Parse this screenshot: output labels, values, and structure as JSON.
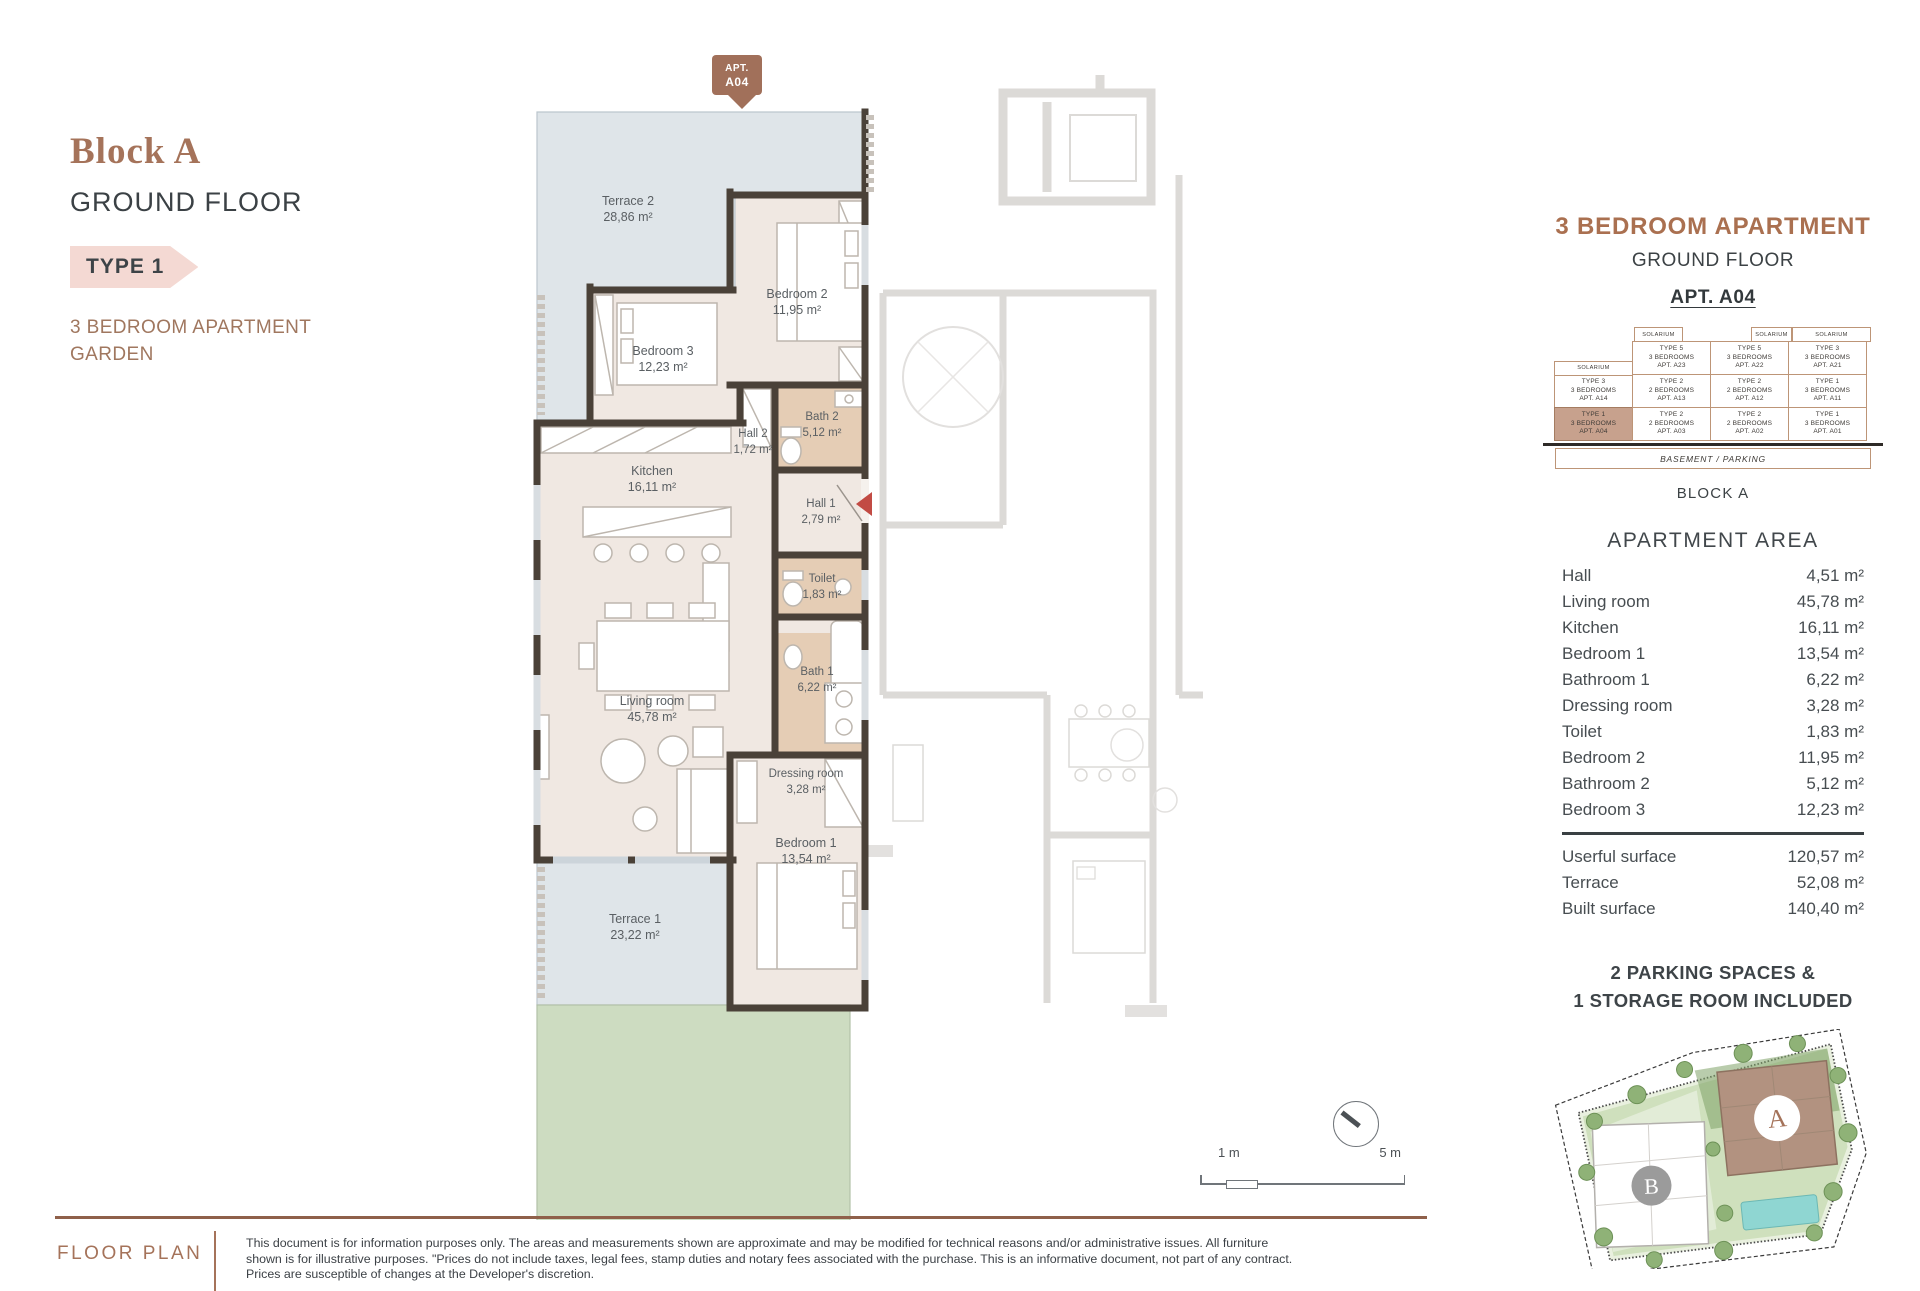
{
  "header": {
    "block_title": "Block A",
    "floor": "GROUND FLOOR",
    "type_tag": "TYPE 1",
    "subtitle_line1": "3 BEDROOM APARTMENT",
    "subtitle_line2": "GARDEN"
  },
  "plan": {
    "pin": {
      "line1": "APT.",
      "line2": "A04"
    },
    "rooms": [
      {
        "name": "Terrace 2",
        "area": "28,86 m²",
        "x": 103,
        "y": 150,
        "small": false
      },
      {
        "name": "Bedroom 2",
        "area": "11,95 m²",
        "x": 272,
        "y": 243,
        "small": false
      },
      {
        "name": "Bedroom 3",
        "area": "12,23 m²",
        "x": 138,
        "y": 300,
        "small": false
      },
      {
        "name": "Hall 2",
        "area": "1,72 m²",
        "x": 228,
        "y": 382,
        "small": true
      },
      {
        "name": "Bath 2",
        "area": "5,12 m²",
        "x": 297,
        "y": 365,
        "small": true
      },
      {
        "name": "Kitchen",
        "area": "16,11 m²",
        "x": 127,
        "y": 420,
        "small": false
      },
      {
        "name": "Hall 1",
        "area": "2,79 m²",
        "x": 296,
        "y": 452,
        "small": true
      },
      {
        "name": "Toilet",
        "area": "1,83 m²",
        "x": 297,
        "y": 527,
        "small": true
      },
      {
        "name": "Living room",
        "area": "45,78 m²",
        "x": 127,
        "y": 650,
        "small": false
      },
      {
        "name": "Bath 1",
        "area": "6,22 m²",
        "x": 292,
        "y": 620,
        "small": true
      },
      {
        "name": "Dressing room",
        "area": "3,28 m²",
        "x": 281,
        "y": 722,
        "small": true
      },
      {
        "name": "Bedroom 1",
        "area": "13,54 m²",
        "x": 281,
        "y": 792,
        "small": false
      },
      {
        "name": "Terrace 1",
        "area": "23,22 m²",
        "x": 110,
        "y": 868,
        "small": false
      }
    ],
    "scale": {
      "left_label": "1 m",
      "right_label": "5 m"
    }
  },
  "right_panel": {
    "title": "3 BEDROOM APARTMENT",
    "subtitle": "GROUND FLOOR",
    "apt": "APT. A04",
    "stack": {
      "solarium_label": "SOLARIUM",
      "floor_rows": [
        [
          null,
          {
            "type": "TYPE 5",
            "beds": "3 BEDROOMS",
            "apt": "APT. A23"
          },
          {
            "type": "TYPE 5",
            "beds": "3 BEDROOMS",
            "apt": "APT. A22"
          },
          {
            "type": "TYPE 3",
            "beds": "3 BEDROOMS",
            "apt": "APT. A21"
          }
        ],
        [
          {
            "type": "TYPE 3",
            "beds": "3 BEDROOMS",
            "apt": "APT. A14"
          },
          {
            "type": "TYPE 2",
            "beds": "2 BEDROOMS",
            "apt": "APT. A13"
          },
          {
            "type": "TYPE 2",
            "beds": "2 BEDROOMS",
            "apt": "APT. A12"
          },
          {
            "type": "TYPE 1",
            "beds": "3 BEDROOMS",
            "apt": "APT. A11"
          }
        ],
        [
          {
            "type": "TYPE 1",
            "beds": "3 BEDROOMS",
            "apt": "APT. A04",
            "highlight": true
          },
          {
            "type": "TYPE 2",
            "beds": "2 BEDROOMS",
            "apt": "APT. A03"
          },
          {
            "type": "TYPE 2",
            "beds": "2 BEDROOMS",
            "apt": "APT. A02"
          },
          {
            "type": "TYPE 1",
            "beds": "3 BEDROOMS",
            "apt": "APT. A01"
          }
        ]
      ],
      "basement": "BASEMENT / PARKING"
    },
    "block_label": "BLOCK A",
    "area_title": "APARTMENT AREA",
    "areas": [
      {
        "label": "Hall",
        "value": "4,51 m²"
      },
      {
        "label": "Living room",
        "value": "45,78 m²"
      },
      {
        "label": "Kitchen",
        "value": "16,11 m²"
      },
      {
        "label": "Bedroom 1",
        "value": "13,54 m²"
      },
      {
        "label": "Bathroom 1",
        "value": "6,22 m²"
      },
      {
        "label": "Dressing room",
        "value": "3,28 m²"
      },
      {
        "label": "Toilet",
        "value": "1,83 m²"
      },
      {
        "label": "Bedroom 2",
        "value": "11,95 m²"
      },
      {
        "label": "Bathroom 2",
        "value": "5,12 m²"
      },
      {
        "label": "Bedroom 3",
        "value": "12,23 m²"
      }
    ],
    "totals": [
      {
        "label": "Userful surface",
        "value": "120,57 m²"
      },
      {
        "label": "Terrace",
        "value": "52,08 m²"
      },
      {
        "label": "Built surface",
        "value": "140,40 m²"
      }
    ],
    "parking_line1": "2 PARKING SPACES &",
    "parking_line2": "1 STORAGE ROOM INCLUDED",
    "siteplan": {
      "block_a_label": "A",
      "block_b_label": "B"
    }
  },
  "footer": {
    "label": "FLOOR PLAN",
    "disclaimer_lines": [
      "This document is for information purposes only. The areas and measurements shown are approximate and may be modified for technical reasons and/or administrative issues. All furniture",
      "shown is for illustrative purposes. \"Prices do not include taxes, legal fees, stamp duties and notary fees associated with the purchase. This is an informative document, not part of any contract.",
      "Prices are susceptible of changes at the Developer's discretion."
    ]
  },
  "colors": {
    "accent_brown": "#a5735a",
    "wall": "#4a4138",
    "interior_beige": "#f0e8e2",
    "bathroom_tan": "#e5cdb5",
    "terrace_blue": "#dfe5e9",
    "garden_green": "#cddcc1",
    "highlight_cell": "#c7a18d",
    "entrance_arrow_red": "#c24b44",
    "type_tag_pink": "#f4d9d3"
  }
}
